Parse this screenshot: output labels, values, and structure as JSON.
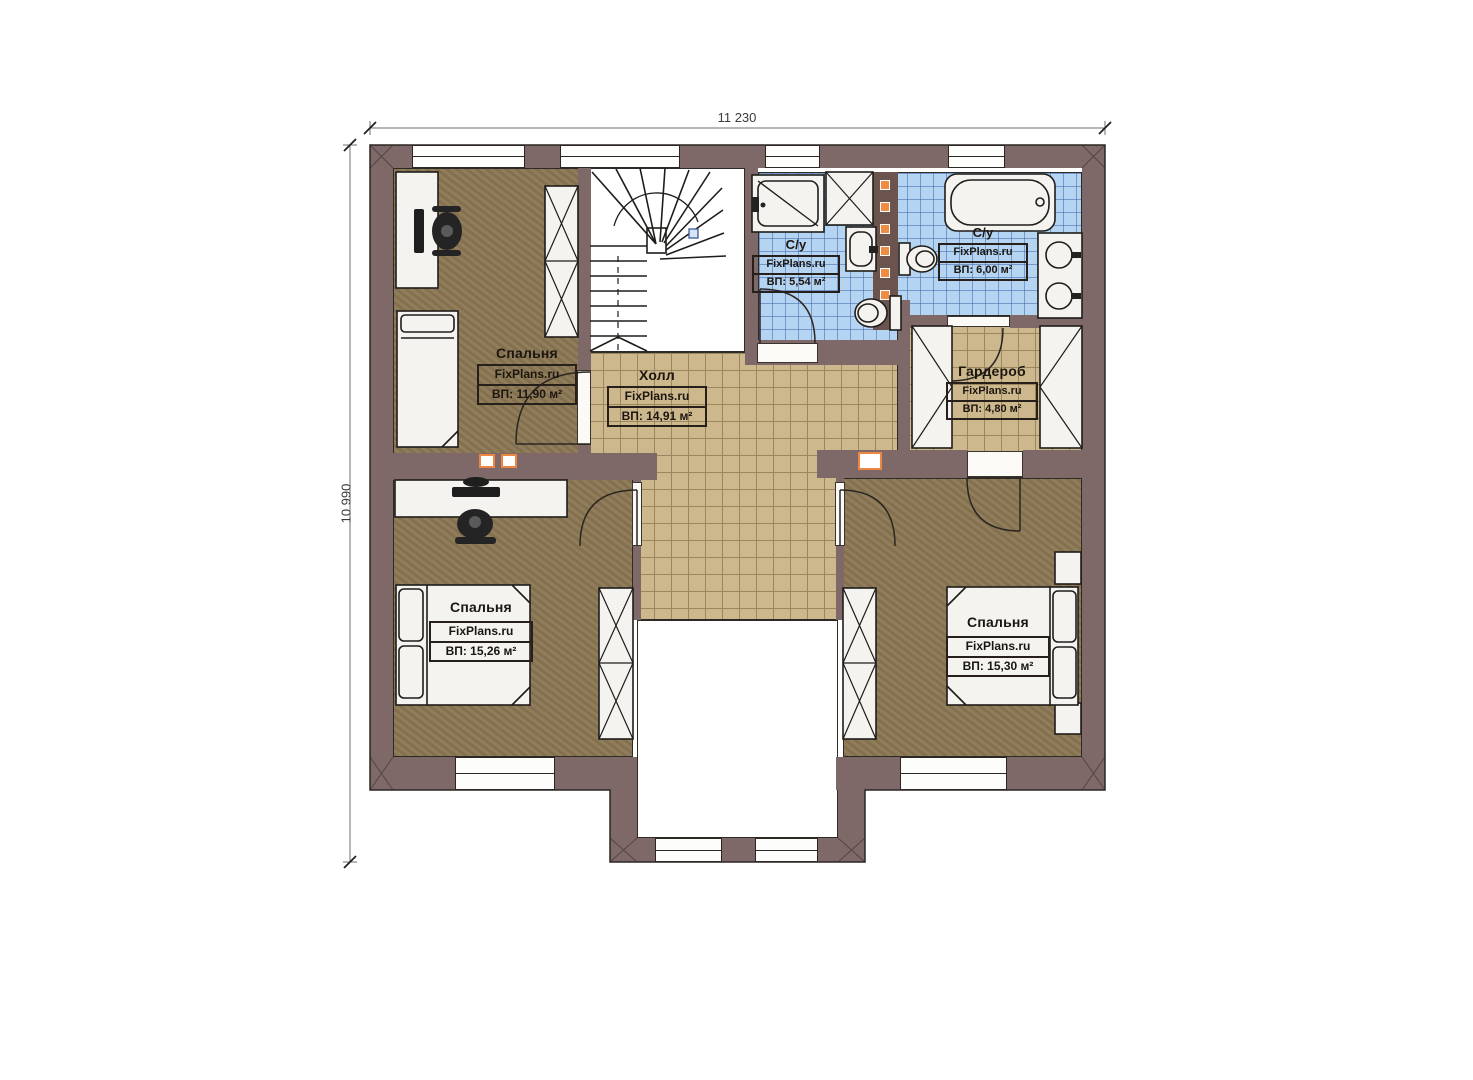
{
  "watermark": "FixPlans.ru",
  "dimensions": {
    "width_label": "11 230",
    "height_label": "10 990"
  },
  "rooms": [
    {
      "name": "Спальня",
      "area": "ВП: 11,90 м²"
    },
    {
      "name": "Холл",
      "area": "ВП: 14,91 м²"
    },
    {
      "name": "С/у",
      "area": "ВП: 5,54 м²"
    },
    {
      "name": "С/у",
      "area": "ВП: 6,00 м²"
    },
    {
      "name": "Гардероб",
      "area": "ВП: 4,80 м²"
    },
    {
      "name": "Спальня",
      "area": "ВП: 15,26 м²"
    },
    {
      "name": "Спальня",
      "area": "ВП: 15,30 м²"
    }
  ],
  "colors": {
    "wall": "#7e6868",
    "wood_floor": "#8a7653",
    "tile_tan": "#cdb88e",
    "tile_blue": "#b5d4f1",
    "vent_orange": "#ec8640"
  }
}
